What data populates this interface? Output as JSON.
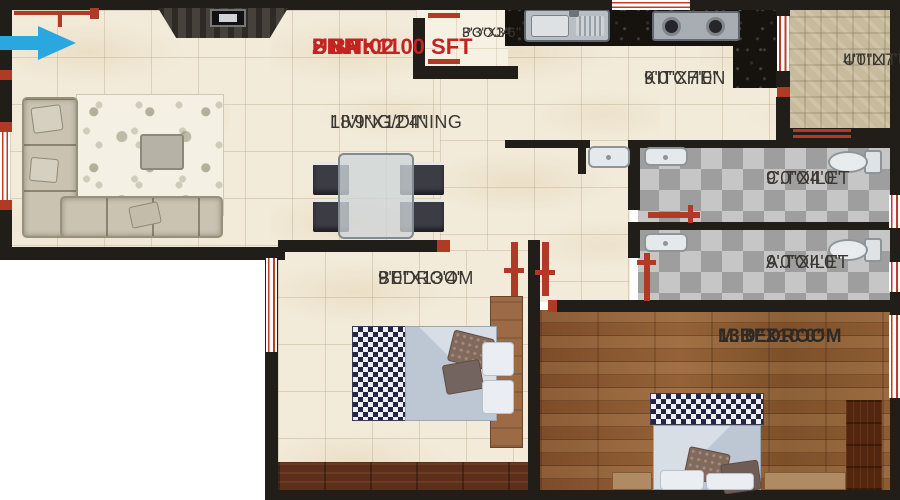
{
  "header": {
    "unit": "UNIT 02",
    "sba": "SBA : 1100 SFT",
    "bhk": "2 BHK"
  },
  "rooms": {
    "living": {
      "name": "LIVING/DINING",
      "dims": "18'9\"X12'4\""
    },
    "pooja": {
      "name": "POOJA",
      "dims": "3'3\"X3'6\""
    },
    "kitchen": {
      "name": "KITCHEN",
      "dims": "9'0\"X7'0\""
    },
    "utility": {
      "name": "UTILITY",
      "dims": "4'0\"X7'6\""
    },
    "c_toilet": {
      "name": "C.TOILET",
      "dims": "9'0\"X4'0\""
    },
    "a_toilet": {
      "name": "A.TOILET",
      "dims": "9'0\"X4'0\""
    },
    "bedroom": {
      "name": "BEDROOM",
      "dims": "9'0\"X13'4\""
    },
    "m_bedroom": {
      "name": "M.BEDROOM",
      "dims": "13'0\"X10'0\""
    }
  },
  "colors": {
    "accent_red": "#c42421",
    "wall_black": "#211d19",
    "floor_cream": "#f2ebda",
    "master_wood": "#875833",
    "toilet_tile_gray": "#b0b0b0",
    "utility_tan": "#c7ba9d",
    "door_frame_red": "#b03a26",
    "entry_arrow_blue": "#2aa7de"
  },
  "icons": {
    "entry_arrow": "right-arrow"
  }
}
